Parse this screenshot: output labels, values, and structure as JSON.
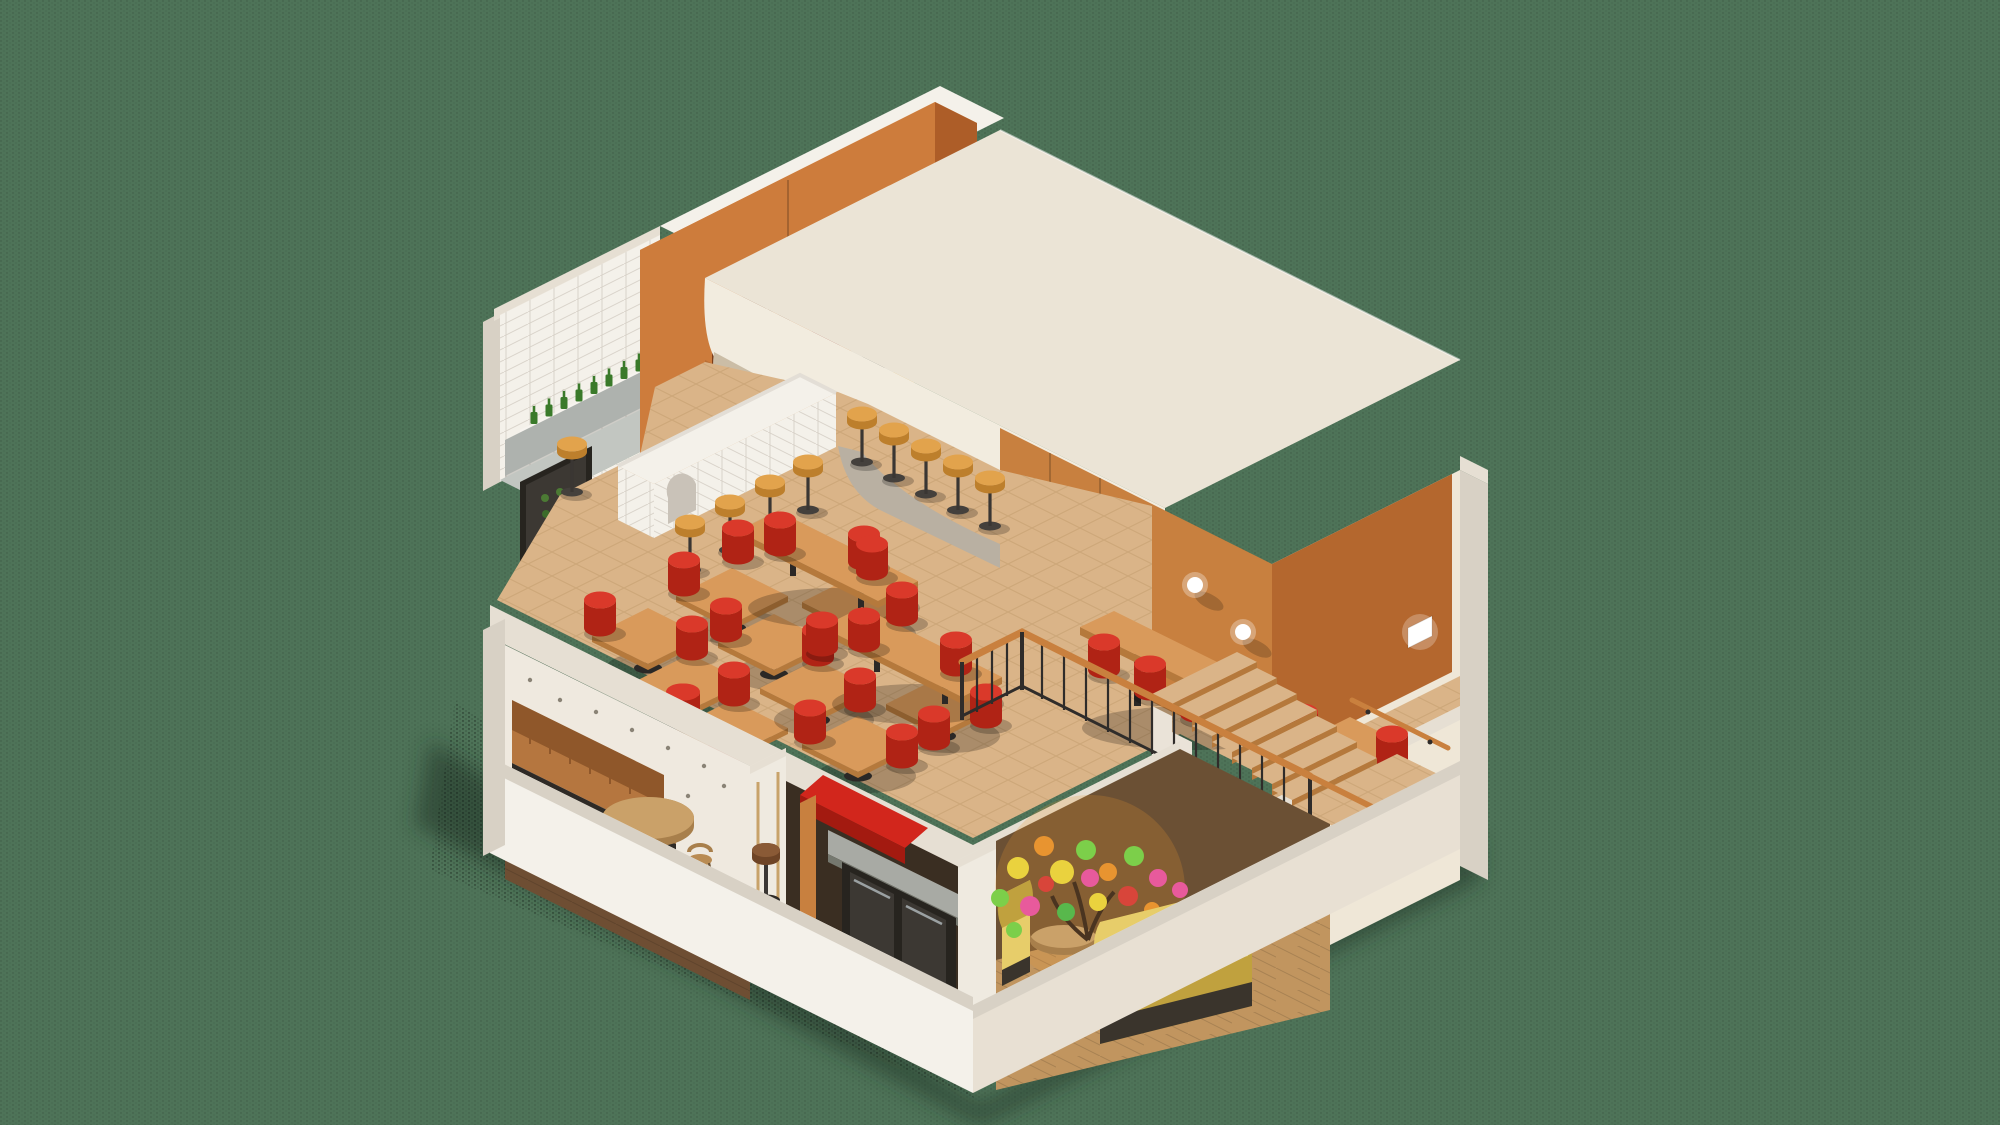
{
  "meta": {
    "description": "Isometric cutaway 3D render of a two-story fast-casual restaurant on a dark sage dithered background: upper dining floor with tiled kitchen wall, wine-bottle shelf, orange wood bar-back towers with cup shelves and POS laptop, white tiled bar with yellow stools, large white rounded service volume with open stainless kitchen pass, herringbone parquet dining area with wooden tables and red cylinder stools, wood-panelled stairwell with globe sconces and black railing; lower floor with wallpapered lounge and leather banquette, red-roofed kiosk with under-counter fridges, and a yellow-sofa family corner with a confetti-coloured tree.",
    "visible_text": [],
    "style": "isometric architectural cutaway render",
    "image_size": {
      "width": 2000,
      "height": 1125
    }
  },
  "palette": {
    "bg": "#4e7358",
    "shadow": "#1d2d22",
    "roof": "#ebe4d6",
    "fascia": "#f2ecdf",
    "cream-band": "#cbbda6",
    "cut-edge": "#d8d1c5",
    "cut-light": "#e6dfd3",
    "wall-white": "#f4f1ea",
    "tile-line": "#d9d3ca",
    "orange": "#cd7c3c",
    "orange-light": "#e0944f",
    "orange-dark": "#ad5d28",
    "wood-wall": "#c8803f",
    "wood-wall-dark": "#b4672e",
    "cab-yellow": "#daa33c",
    "cab-yellow-dark": "#8f6d1f",
    "steel": "#a8aaa4",
    "steel-dark": "#75786f",
    "parquet": "#dab488",
    "parquet-line": "#c09a69",
    "plank": "#c1955f",
    "floor-dark": "#6e4e33",
    "red": "#da392a",
    "red-dark": "#b02315",
    "table-top": "#d99a5b",
    "table-edge": "#b5793c",
    "ped-black": "#2b2826",
    "stool-yellow": "#e2a34c",
    "stool-yellow-dark": "#bd7f2c",
    "banquette": "#b5763f",
    "banquette-dark": "#8f572a",
    "sofa": "#e7cd6a",
    "sofa-dark": "#c0a13e",
    "olive": "#6b5034",
    "wallpaper": "#efe9df",
    "bottle": "#3a7a2a",
    "cup": "#f2ede4",
    "laptop": "#2f7d8c",
    "copper": "#b5713f",
    "kiosk-red": "#d2261c",
    "kiosk-red-dark": "#a31a10",
    "glow": "#ffffff",
    "rail-wood": "#c9803e",
    "rail-black": "#2f2c2a",
    "hood-grey": "#aeb2ae",
    "counter-grey": "#c2c6c1",
    "sink-dark": "#55595a",
    "fridge-black": "#27241f",
    "fridge-frame": "#3c3833",
    "confetti-1": "#e85a9c",
    "confetti-2": "#7ccf4a",
    "confetti-3": "#ead23e",
    "confetti-4": "#e89430",
    "confetti-5": "#d8453a",
    "confetti-6": "#58b84c"
  },
  "scene": {
    "floors": [
      {
        "name": "upper dining floor",
        "features": [
          "white tiled kitchen wall",
          "wine bottle shelf",
          "sink with faucet",
          "range hood",
          "display fridge",
          "pizza-oven alcove",
          "orange bar-back towers with cup alcoves",
          "POS laptop",
          "espresso machine",
          "yellow vented cabinets",
          "white tiled bar counter with arch niche",
          "white service volume with rounded corner",
          "open stainless kitchen pass",
          "herringbone parquet",
          "stairwell with black railing",
          "wood panelled stair wall",
          "globe wall sconces",
          "rectangular wall sconce"
        ]
      },
      {
        "name": "lower lounge floor",
        "features": [
          "patterned wallpaper lounge with leather banquette and round table",
          "red-roofed kiosk counter with under-counter fridges",
          "yellow sofa family corner with confetti tree",
          "wood plank flooring",
          "white cut partition walls",
          "staircase landing"
        ]
      }
    ],
    "furniture_counts": {
      "wine_bottles": 9,
      "cups_on_shelves": 17,
      "yellow_bar_stools": 5,
      "counter_stools": 5,
      "square_tables": 10,
      "rect_tables": 2,
      "communal_tables": 1,
      "red_stools": 27,
      "round_tables_lower": 2,
      "wood_chairs": 2,
      "banquettes": 1,
      "yellow_sofas": 2,
      "brown_stools": 1,
      "globe_sconces": 2,
      "rect_sconces": 1,
      "stair_flights": 2,
      "confetti_tree": 1
    },
    "tree": {
      "colors": [
        "#e85a9c",
        "#7ccf4a",
        "#ead23e",
        "#e89430",
        "#d8453a",
        "#58b84c"
      ],
      "leaf_count": 20
    }
  }
}
